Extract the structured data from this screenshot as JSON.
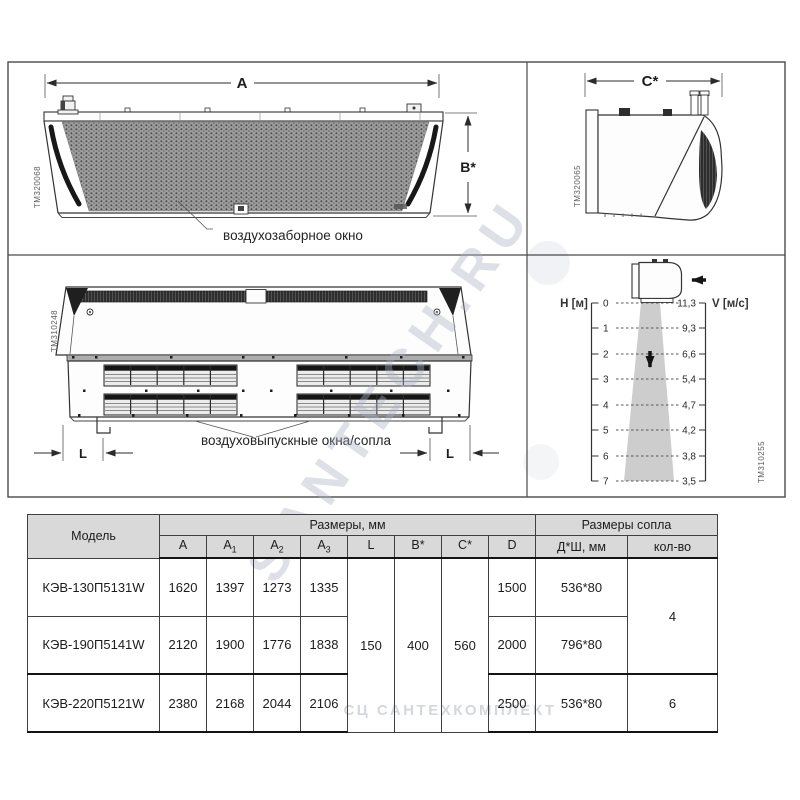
{
  "watermarks": {
    "diagonal": "SANTECH.RU",
    "bottom": "СЦ САНТЕХКОМПЛЕКТ"
  },
  "panels": {
    "front_view": {
      "code": "TM320068",
      "dim_width": "A",
      "dim_height": "B*",
      "callout": "воздухозаборное окно"
    },
    "side_view": {
      "code": "TM320065",
      "dim_depth": "C*"
    },
    "bottom_view": {
      "code": "TM310248",
      "dim_l_left": "L",
      "dim_l_right": "L",
      "callout": "воздуховыпускные окна/сопла"
    },
    "airflow": {
      "code": "TM310255",
      "axis_height": "H [м]",
      "axis_velocity": "V [м/с]",
      "h_ticks": [
        "0",
        "1",
        "2",
        "3",
        "4",
        "5",
        "6",
        "7"
      ],
      "v_ticks": [
        "11,3",
        "9,3",
        "6,6",
        "5,4",
        "4,7",
        "4,2",
        "3,8",
        "3,5"
      ]
    }
  },
  "table": {
    "model_header": "Модель",
    "dims_group": "Размеры, мм",
    "nozzle_group": "Размеры сопла",
    "dim_cols": [
      {
        "base": "A",
        "sub": ""
      },
      {
        "base": "A",
        "sub": "1"
      },
      {
        "base": "A",
        "sub": "2"
      },
      {
        "base": "A",
        "sub": "3"
      },
      {
        "base": "L",
        "sub": ""
      },
      {
        "base": "B*",
        "sub": ""
      },
      {
        "base": "C*",
        "sub": ""
      },
      {
        "base": "D",
        "sub": ""
      }
    ],
    "nozzle_cols": [
      "Д*Ш, мм",
      "кол-во"
    ],
    "rows": [
      {
        "model": "КЭВ-130П5131W",
        "a": "1620",
        "a1": "1397",
        "a2": "1273",
        "a3": "1335",
        "d": "1500",
        "nozzle_size": "536*80"
      },
      {
        "model": "КЭВ-190П5141W",
        "a": "2120",
        "a1": "1900",
        "a2": "1776",
        "a3": "1838",
        "d": "2000",
        "nozzle_size": "796*80"
      },
      {
        "model": "КЭВ-220П5121W",
        "a": "2380",
        "a1": "2168",
        "a2": "2044",
        "a3": "2106",
        "d": "2500",
        "nozzle_size": "536*80"
      }
    ],
    "merged": {
      "l": "150",
      "b": "400",
      "c": "560",
      "qty_rows12": "4",
      "qty_row3": "6"
    }
  },
  "chart_data": {
    "type": "line",
    "title": "",
    "x": [
      0,
      1,
      2,
      3,
      4,
      5,
      6,
      7
    ],
    "xlabel": "H [м]",
    "ylabel": "V [м/с]",
    "values": [
      11.3,
      9.3,
      6.6,
      5.4,
      4.7,
      4.2,
      3.8,
      3.5
    ],
    "xlim": [
      0,
      7
    ],
    "legend": []
  }
}
